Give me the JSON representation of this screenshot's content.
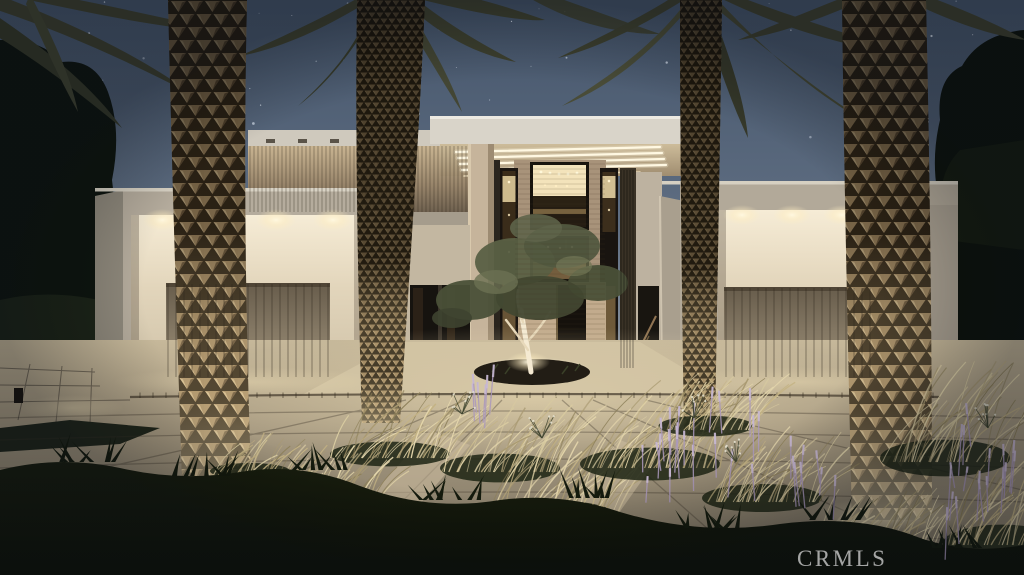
{
  "scene": {
    "title": "Modern two-story luxury home exterior at dusk",
    "time_of_day": "dusk",
    "elements": [
      "starry dusk sky",
      "two-story glass entry tower with warm interior lighting",
      "entry canopy with linear soffit lights",
      "left garage wing with recessed downlights and wood-slat door",
      "right garage wing with recessed downlights and wood-slat door",
      "wood slat upper facade band",
      "four uplit palm tree trunks",
      "olive tree in circular planter",
      "concrete paver driveway and courtyard",
      "ornamental golden grasses",
      "purple flower spikes",
      "dark foreground shrub silhouettes",
      "dark trees flanking the property",
      "path light bottom left"
    ]
  },
  "watermark": {
    "label": "CRMLS"
  },
  "palette": {
    "sky_top": "#45556b",
    "sky_horizon": "#979ca4",
    "stucco_lit": "#e8decb",
    "stucco_shadow": "#a79f90",
    "recess_glow": "#f3e9d2",
    "wood_door": "#7d7260",
    "interior_glow": "#f3e3bb",
    "palm_scale": "#ab9169",
    "palm_scale_highlight": "#d6bf93",
    "palm_crevice": "#312718",
    "frond_olive": "#3e4130",
    "concrete_lit": "#d6c7a6",
    "concrete_dark": "#776e5d",
    "foliage_dark": "#12160b",
    "grass_gold": "#cdbd8e",
    "flower_purple": "#ab99bd",
    "tree_dark": "#0e150f",
    "watermark_gray": "#c6c6c6"
  }
}
